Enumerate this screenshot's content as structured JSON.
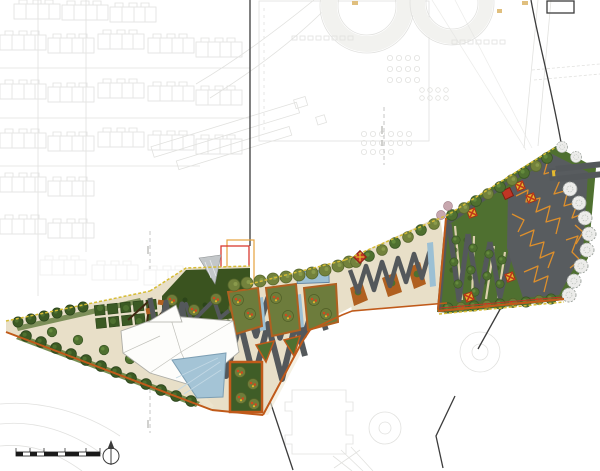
{
  "document": {
    "kind": "landscape-masterplan",
    "description": "Rendered landscape master plan: a linear park winding from a tree-lined wedge (south-west) through a central plaza with zigzag walkways, pools and planting islands, up a diagonal link walk to a fan-shaped east park with lawn strips and a dark crack-patterned plaza. Surrounding housing blocks, campus buildings and roads are faint CAD linework. No legible text labels appear in the drawing.",
    "background": "#ffffff"
  },
  "palette": {
    "background": "#ffffff",
    "cad_linework": "#dadad7",
    "boundary": "#3c3c3c",
    "plaza": "#e8dfc8",
    "paving_light": "#efe7d2",
    "path": "#54585b",
    "hedge": "#3a531f",
    "lawn": "#4f7030",
    "tree_dark": "#3c5a24",
    "tree_olive": "#73823c",
    "blossom_dot": "#cf4a1e",
    "water": "#9cc0d4",
    "pool": "#a4c4d6",
    "planter": "#b06020",
    "border_orange": "#c05a1a",
    "edge_dash_yellow": "#d6bc35",
    "crackle_plaza": "#585c5f",
    "crackle_line": "#dd8f2c",
    "marker_red": "#c13524",
    "marker_yellow": "#e3b92f",
    "outline_red": "#d93a30",
    "outline_orange": "#e6a23c",
    "tree_gray": "#ececea",
    "tree_pink": "#c7a7ae",
    "scale_bar": "#1a1a1a",
    "tan_marker": "#d9b05e"
  },
  "regions": {
    "west_wedge": "Tree-lined promenade wedge",
    "hedge_garden": "Hedge garden with square tree planters",
    "central_plaza": "Central plaza with zigzag walkways, planting islands and water cascade",
    "pavilion_building": "White angular pavilion building",
    "triangular_pool": "Triangular reflecting pool",
    "linear_pool": "Linear pool at plaza top edge",
    "link_walk": "Diagonal link walk with zigzag planters",
    "east_park": "Fan-shaped east park with lawn strips",
    "crackle_plaza": "Dark plaza with orange crack-pattern paving",
    "piers": "Twin deck piers at north-east corner",
    "context": "Faint surrounding buildings and roads (CAD linework)",
    "site_boundary": "Dark site boundary polylines",
    "permit_outlines": "Red and orange setback rectangles"
  },
  "markers": {
    "pavilion_x": {
      "label": "pavilion marker (yellow square, red cross)",
      "fill": "#e3b92f",
      "cross": "#c23a1a"
    },
    "entry_diamond": {
      "label": "entry marker (red diamond)",
      "fill": "#c13524"
    }
  },
  "annotations": {
    "scale_bar": {
      "segments_black": 5,
      "style": "alternating black and white bar with ticks",
      "color": "#1a1a1a"
    },
    "north_arrow": {
      "shape": "circle with vertical needle and solid arrowhead",
      "direction": "up"
    }
  }
}
